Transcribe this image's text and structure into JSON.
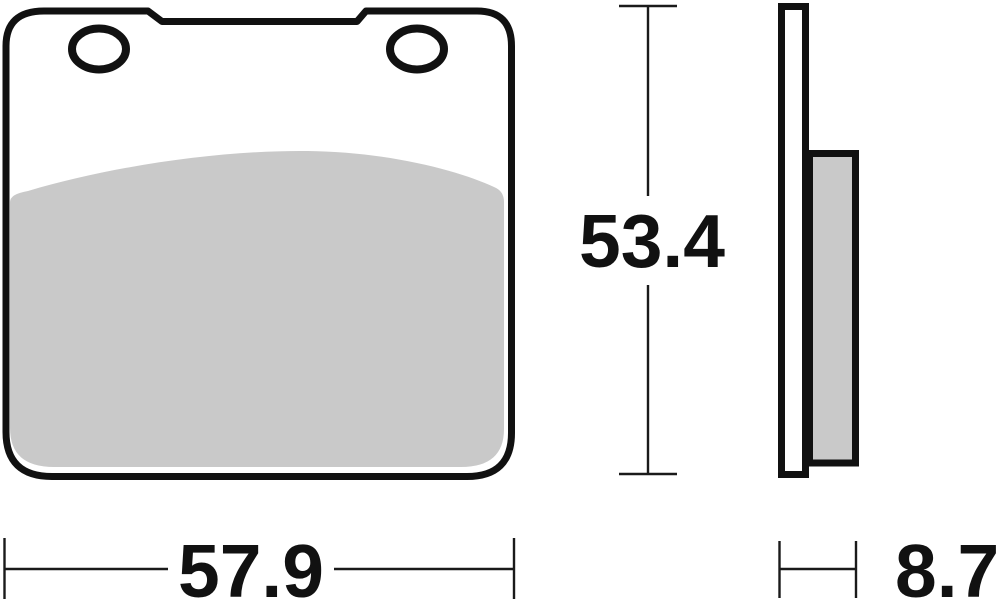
{
  "diagram": {
    "dimensions": {
      "width": "57.9",
      "height": "53.4",
      "thickness": "8.7"
    },
    "colors": {
      "outline": "#111111",
      "friction_material": "#c9c9c9",
      "background": "#ffffff",
      "dimension_lines": "#1a1a1a"
    }
  }
}
